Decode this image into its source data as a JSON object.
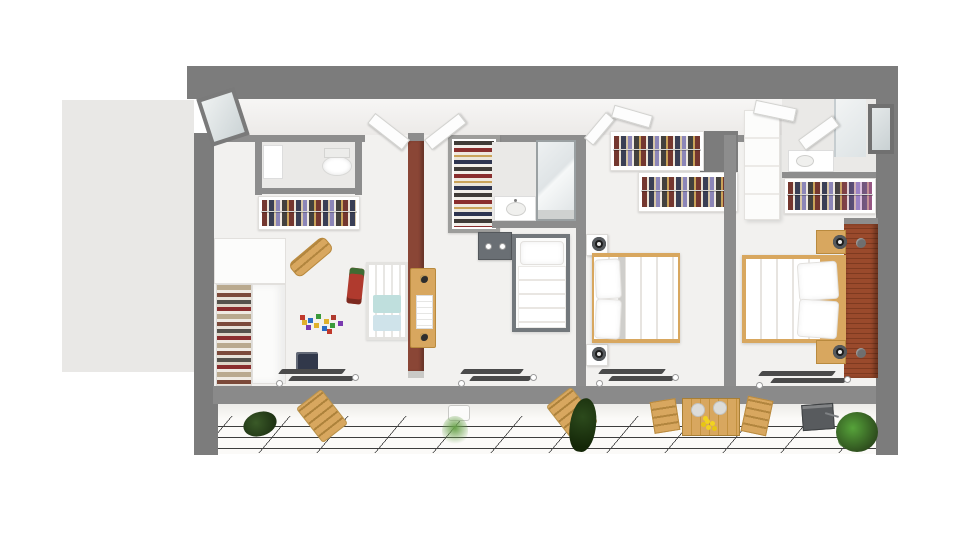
{
  "scene": {
    "title": "3D floor plan — upper floor, top-down dollhouse view",
    "type": "architectural-floorplan-render",
    "no_visible_text": true
  },
  "palette": {
    "background": "#ffffff",
    "exterior_wall": "#7c7c7c",
    "interior_wall": "#8d8d8d",
    "bottom_wall": "#8a8a8a",
    "hall_floor": "#f0efed",
    "room_floor": "#f2f1ef",
    "bath_floor": "#eae9e7",
    "roof_area": "#e9e8e6",
    "accent_wall": "#8a4636",
    "brick_wall": "#9a4a2c",
    "wood": "#d8a75f",
    "wood_dark": "#b98a3e",
    "terrace_floor": "#fbfaf8",
    "tile_line": "#3d3d3d",
    "door_white": "#fdfdfd",
    "glass": "#e3e8e9",
    "plant_dark": "#2c4a1c",
    "plant_green": "#4c8a33",
    "grill_gray": "#585b5e",
    "crib_blue": "#cfe3ea",
    "lamp_black": "#1c1c1c"
  },
  "rooms": [
    {
      "id": "hallway",
      "label": "hallway along top wall"
    },
    {
      "id": "nursery",
      "label": "kids room",
      "furniture": [
        "ensuite wc with toilet",
        "hanging-clothes closet",
        "open wardrobe with folded clothes",
        "crib with blue bedding",
        "wooden rocking toy",
        "red toy truck",
        "scattered building blocks",
        "toy box",
        "wooden changing dresser on red accent wall"
      ]
    },
    {
      "id": "bedroom-single",
      "label": "single bedroom",
      "furniture": [
        "shoe closet",
        "dark wall cabinet",
        "single bed with gray frame"
      ]
    },
    {
      "id": "bathroom",
      "label": "central bathroom",
      "furniture": [
        "washbasin counter",
        "glass shower cabin"
      ]
    },
    {
      "id": "bedroom-double",
      "label": "double bedroom",
      "furniture": [
        "two white racks with hanging clothes",
        "double bed with wooden frame",
        "two white nightstands",
        "two round black wall lamps"
      ]
    },
    {
      "id": "master-bedroom",
      "label": "master bedroom",
      "furniture": [
        "ensuite bathroom with basin and window",
        "white wardrobe",
        "clothes rack",
        "double bed with wooden frame",
        "two wooden nightstands with black lamps",
        "red brick headboard wall"
      ]
    },
    {
      "id": "balcony",
      "label": "tiled balcony terrace",
      "furniture": [
        "dark potted plant",
        "two wooden lounge chairs",
        "white planter with grass",
        "tall dark plant",
        "plank dining table with yellow flowers and two benches",
        "dark storage box",
        "round green shrub"
      ]
    }
  ],
  "openings": {
    "white_swing_doors": 6,
    "floor_window_assemblies": 5,
    "roof_window_top_left": 1,
    "side_window_right_wall": 1
  }
}
